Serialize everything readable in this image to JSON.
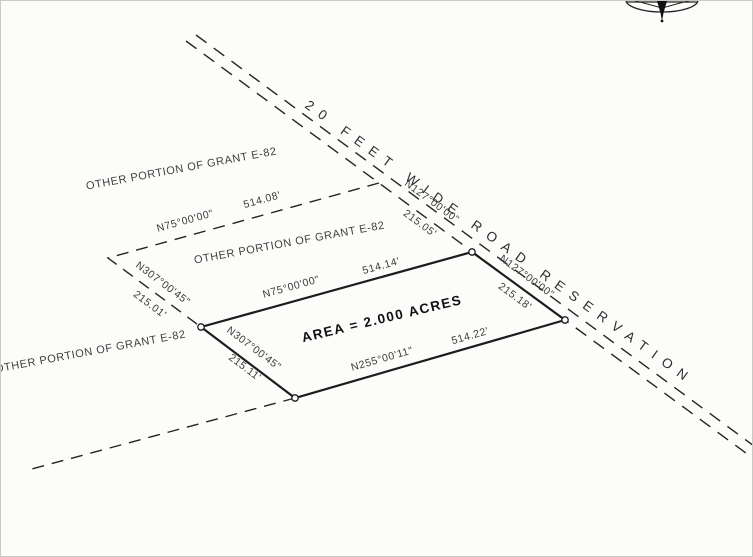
{
  "drawing": {
    "type": "survey-plat",
    "parcel": {
      "area_label": "AREA = 2.000 ACRES"
    },
    "road": {
      "label": "20 FEET WIDE ROAD RESERVATION"
    },
    "grant_labels": [
      {
        "text": "OTHER PORTION OF GRANT E-82"
      },
      {
        "text": "OTHER PORTION OF GRANT E-82"
      },
      {
        "text": "OTHER PORTION OF GRANT E-82"
      }
    ],
    "dimensions": {
      "top_outer": {
        "bearing": "N75°00'00\"",
        "distance": "514.08'"
      },
      "top_inner": {
        "bearing": "N75°00'00\"",
        "distance": "514.14'"
      },
      "right_upper": {
        "bearing": "N127°00'00\"",
        "distance": "215.05'"
      },
      "right_lower": {
        "bearing": "N127°00'00\"",
        "distance": "215.18'"
      },
      "left_upper": {
        "bearing": "N307°00'45\"",
        "distance": "215.01'"
      },
      "left_lower": {
        "bearing": "N307°00'45\"",
        "distance": "215.11'"
      },
      "bottom": {
        "bearing": "N255°00'11\"",
        "distance": "514.22'"
      }
    },
    "colors": {
      "line": "#1c1c1c",
      "text": "#3a3a3a",
      "paper": "#fcfcfa"
    }
  }
}
